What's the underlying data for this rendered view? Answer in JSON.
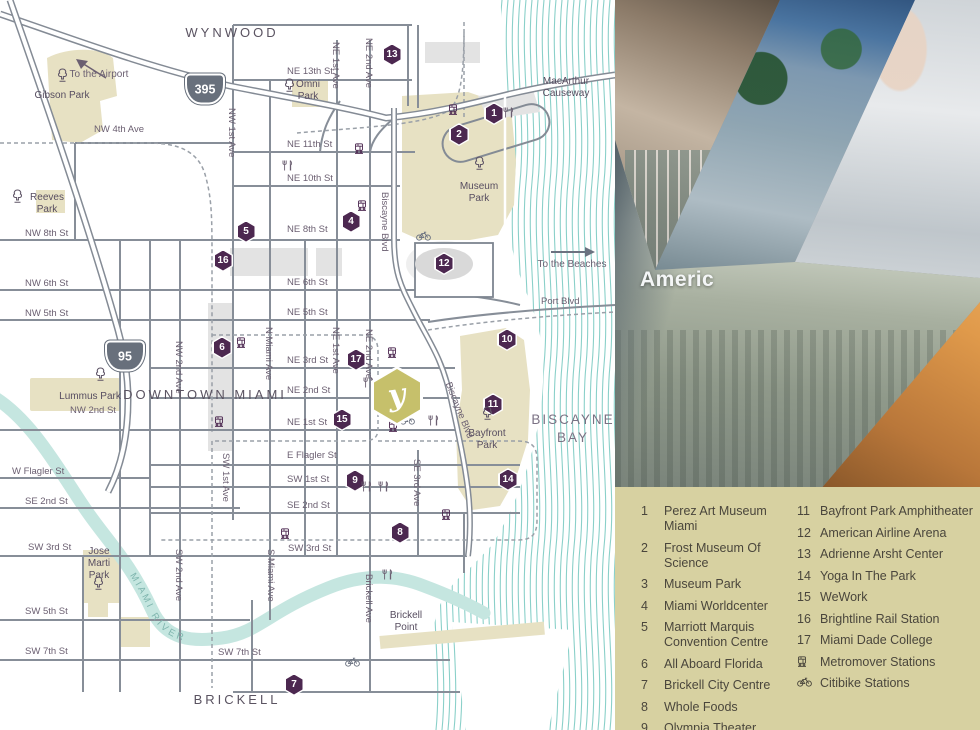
{
  "colors": {
    "purple": "#4c2850",
    "labelc": "#6b5f71",
    "parklbl": "#574d60",
    "parkfill": "#e7e1c3",
    "wave": "#8ad0c9",
    "river": "#c5e6e0",
    "riverlbl": "#7fb5ae",
    "road": "#878e98",
    "legendbg": "#d7d1a1",
    "legendtext": "#4a463c",
    "hexolive": "#c6c06b",
    "blockgray": "#e3e3e3",
    "baylbl": "#7b7284"
  },
  "map": {
    "river_label": "MIAMI RIVER",
    "property_marker": {
      "glyph": "y"
    },
    "shields": [
      {
        "t": "395",
        "x": 205,
        "y": 89
      },
      {
        "t": "95",
        "x": 125,
        "y": 356
      }
    ],
    "markers": [
      {
        "n": "1",
        "x": 494,
        "y": 114
      },
      {
        "n": "2",
        "x": 459,
        "y": 135
      },
      {
        "n": "4",
        "x": 351,
        "y": 222
      },
      {
        "n": "5",
        "x": 246,
        "y": 232
      },
      {
        "n": "6",
        "x": 222,
        "y": 348
      },
      {
        "n": "7",
        "x": 294,
        "y": 685
      },
      {
        "n": "8",
        "x": 400,
        "y": 533
      },
      {
        "n": "9",
        "x": 355,
        "y": 481
      },
      {
        "n": "10",
        "x": 507,
        "y": 340
      },
      {
        "n": "11",
        "x": 493,
        "y": 405
      },
      {
        "n": "12",
        "x": 444,
        "y": 264
      },
      {
        "n": "13",
        "x": 392,
        "y": 55
      },
      {
        "n": "14",
        "x": 508,
        "y": 480
      },
      {
        "n": "15",
        "x": 342,
        "y": 420
      },
      {
        "n": "16",
        "x": 223,
        "y": 261
      },
      {
        "n": "17",
        "x": 356,
        "y": 360
      }
    ],
    "labels": [
      {
        "c": "st",
        "t": "NE 13th St",
        "x": 287,
        "y": 67
      },
      {
        "c": "st",
        "t": "NE 11th St",
        "x": 287,
        "y": 140
      },
      {
        "c": "st",
        "t": "NE 10th St",
        "x": 287,
        "y": 174
      },
      {
        "c": "st",
        "t": "NE 8th St",
        "x": 287,
        "y": 225
      },
      {
        "c": "st",
        "t": "NE 6th St",
        "x": 287,
        "y": 278
      },
      {
        "c": "st",
        "t": "NE 5th St",
        "x": 287,
        "y": 308
      },
      {
        "c": "st",
        "t": "NE 3rd St",
        "x": 287,
        "y": 356
      },
      {
        "c": "st",
        "t": "NE 2nd St",
        "x": 287,
        "y": 386
      },
      {
        "c": "st",
        "t": "NE 1st St",
        "x": 287,
        "y": 418
      },
      {
        "c": "st",
        "t": "E Flagler St",
        "x": 287,
        "y": 451
      },
      {
        "c": "st",
        "t": "SW 1st St",
        "x": 287,
        "y": 475
      },
      {
        "c": "st",
        "t": "SE 2nd St",
        "x": 287,
        "y": 501
      },
      {
        "c": "st",
        "t": "SW 3rd St",
        "x": 288,
        "y": 544
      },
      {
        "c": "st",
        "t": "SW 7th St",
        "x": 218,
        "y": 648
      },
      {
        "c": "st",
        "t": "NW 8th St",
        "x": 25,
        "y": 229
      },
      {
        "c": "st",
        "t": "NW 6th St",
        "x": 25,
        "y": 279
      },
      {
        "c": "st",
        "t": "NW 5th St",
        "x": 25,
        "y": 309
      },
      {
        "c": "st",
        "t": "W Flagler St",
        "x": 12,
        "y": 467
      },
      {
        "c": "st",
        "t": "SE 2nd St",
        "x": 25,
        "y": 497
      },
      {
        "c": "st",
        "t": "SW 3rd St",
        "x": 28,
        "y": 543
      },
      {
        "c": "st",
        "t": "SW 5th St",
        "x": 25,
        "y": 607
      },
      {
        "c": "st",
        "t": "SW 7th St",
        "x": 25,
        "y": 647
      },
      {
        "c": "st",
        "t": "NW 4th Ave",
        "x": 94,
        "y": 125
      },
      {
        "c": "st",
        "t": "NW 2nd St",
        "x": 70,
        "y": 406
      },
      {
        "c": "st",
        "t": "Port Blvd",
        "x": 541,
        "y": 297
      },
      {
        "c": "st vt",
        "t": "NW 1st Ave",
        "x": 236,
        "y": 108,
        "r": 90
      },
      {
        "c": "st vt",
        "t": "NE 1st Ave",
        "x": 340,
        "y": 42,
        "r": 90
      },
      {
        "c": "st vt",
        "t": "NE 2nd Ave",
        "x": 373,
        "y": 38,
        "r": 90
      },
      {
        "c": "st vt",
        "t": "NE 1st Ave",
        "x": 340,
        "y": 327,
        "r": 90
      },
      {
        "c": "st vt",
        "t": "NE 2nd Ave",
        "x": 373,
        "y": 329,
        "r": 90
      },
      {
        "c": "st vt",
        "t": "N Miami Ave",
        "x": 273,
        "y": 327,
        "r": 90
      },
      {
        "c": "st vt",
        "t": "NW 2nd Ave",
        "x": 183,
        "y": 341,
        "r": 90
      },
      {
        "c": "st vt",
        "t": "SW 2nd Ave",
        "x": 183,
        "y": 549,
        "r": 90
      },
      {
        "c": "st vt",
        "t": "S Miami Ave",
        "x": 275,
        "y": 549,
        "r": 90
      },
      {
        "c": "st vt",
        "t": "SW 1st Ave",
        "x": 230,
        "y": 453,
        "r": 90
      },
      {
        "c": "st vt",
        "t": "SE 3rd Ave",
        "x": 421,
        "y": 459,
        "r": 90
      },
      {
        "c": "st vt",
        "t": "Brickell Ave",
        "x": 373,
        "y": 574,
        "r": 90
      },
      {
        "c": "st vt",
        "t": "Biscayne Blvd",
        "x": 389,
        "y": 192,
        "r": 90
      },
      {
        "c": "st vt",
        "t": "Biscayne Blvd",
        "x": 452,
        "y": 381,
        "r": 68
      },
      {
        "c": "nb",
        "t": "WYNWOOD",
        "x": 232,
        "y": 26
      },
      {
        "c": "nb",
        "t": "DOWNTOWN MIAMI",
        "x": 205,
        "y": 388
      },
      {
        "c": "nb",
        "t": "BRICKELL",
        "x": 237,
        "y": 693
      },
      {
        "c": "nb bay",
        "t": "BISCAYNE\nBAY",
        "x": 573,
        "y": 411
      },
      {
        "c": "pk",
        "t": "Gibson Park",
        "x": 62,
        "y": 90
      },
      {
        "c": "pk",
        "t": "Omni\nPark",
        "x": 308,
        "y": 79
      },
      {
        "c": "pk",
        "t": "Reeves\nPark",
        "x": 47,
        "y": 192
      },
      {
        "c": "pk",
        "t": "Museum\nPark",
        "x": 479,
        "y": 181
      },
      {
        "c": "pk",
        "t": "Lummus Park",
        "x": 90,
        "y": 391
      },
      {
        "c": "pk",
        "t": "Bayfront\nPark",
        "x": 487,
        "y": 428
      },
      {
        "c": "pk",
        "t": "Jose\nMarti\nPark",
        "x": 99,
        "y": 546
      },
      {
        "c": "pk",
        "t": "Brickell\nPoint",
        "x": 406,
        "y": 610
      },
      {
        "c": "pk",
        "t": "MacArthur\nCauseway",
        "x": 566,
        "y": 76
      },
      {
        "c": "dir",
        "t": "To the Airport",
        "x": 99,
        "y": 69
      },
      {
        "c": "dir",
        "t": "To the Beaches",
        "x": 572,
        "y": 259
      }
    ],
    "stations": [
      [
        453,
        107
      ],
      [
        359,
        146
      ],
      [
        362,
        203
      ],
      [
        241,
        340
      ],
      [
        392,
        350
      ],
      [
        219,
        419
      ],
      [
        393,
        424
      ],
      [
        285,
        531
      ],
      [
        446,
        512
      ]
    ],
    "forks": [
      [
        508,
        110
      ],
      [
        287,
        163
      ],
      [
        368,
        380
      ],
      [
        433,
        418
      ],
      [
        366,
        484
      ],
      [
        383,
        484
      ],
      [
        387,
        572
      ]
    ],
    "bikes": [
      [
        423,
        233
      ],
      [
        407,
        417
      ],
      [
        352,
        659
      ]
    ],
    "trees": [
      [
        62,
        75
      ],
      [
        289,
        85
      ],
      [
        17,
        196
      ],
      [
        479,
        163
      ],
      [
        100,
        374
      ],
      [
        487,
        413
      ],
      [
        98,
        583
      ]
    ]
  },
  "photos": {
    "arena_sign": "Americ",
    "slices": [
      "street-couple",
      "palm-glass-building",
      "mural-building",
      "arena-plaza-crowd",
      "yoga-woman"
    ]
  },
  "legend": {
    "col1": [
      {
        "n": "1",
        "label": "Perez Art Museum Miami"
      },
      {
        "n": "2",
        "label": "Frost Museum Of Science"
      },
      {
        "n": "3",
        "label": "Museum Park"
      },
      {
        "n": "4",
        "label": "Miami Worldcenter"
      },
      {
        "n": "5",
        "label": "Marriott Marquis Convention Centre"
      },
      {
        "n": "6",
        "label": "All Aboard Florida"
      },
      {
        "n": "7",
        "label": "Brickell City Centre"
      },
      {
        "n": "8",
        "label": "Whole Foods"
      },
      {
        "n": "9",
        "label": "Olympia Theater"
      },
      {
        "n": "10",
        "label": "Bayside Marketplace"
      }
    ],
    "col2": [
      {
        "n": "11",
        "label": "Bayfront Park Amphitheater"
      },
      {
        "n": "12",
        "label": "American Airline Arena"
      },
      {
        "n": "13",
        "label": "Adrienne Arsht Center"
      },
      {
        "n": "14",
        "label": "Yoga In The Park"
      },
      {
        "n": "15",
        "label": "WeWork"
      },
      {
        "n": "16",
        "label": "Brightline Rail Station"
      },
      {
        "n": "17",
        "label": "Miami Dade College"
      },
      {
        "icon": "station",
        "label": "Metromover Stations"
      },
      {
        "icon": "bike",
        "label": "Citibike Stations"
      }
    ]
  }
}
